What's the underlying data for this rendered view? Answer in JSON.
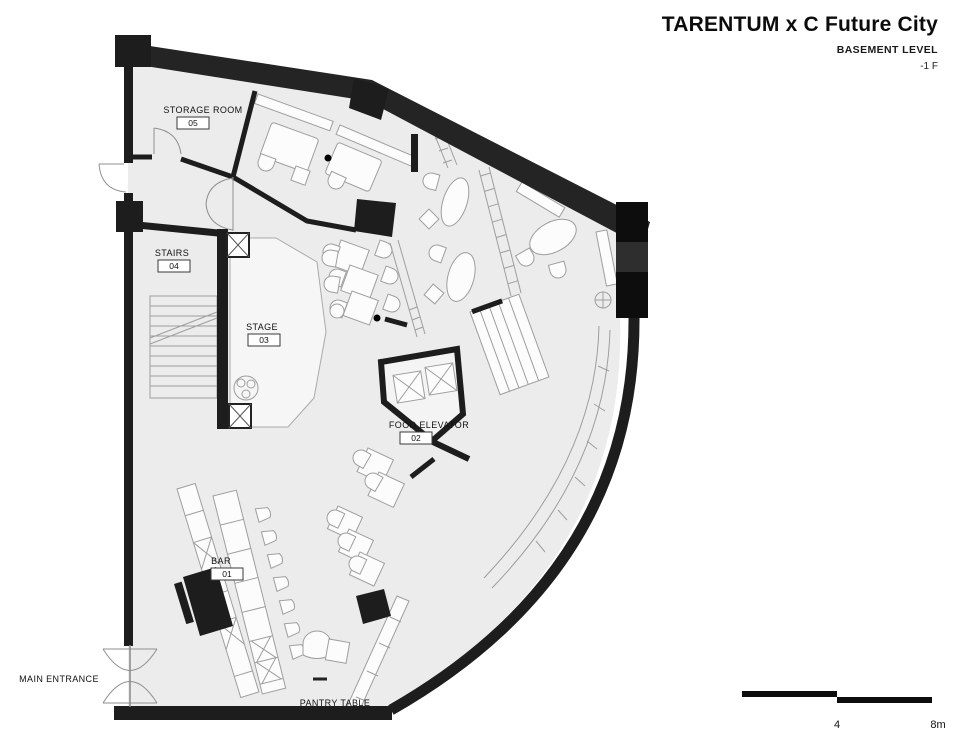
{
  "header": {
    "title": "TARENTUM x C Future City",
    "subtitle": "BASEMENT LEVEL",
    "level": "-1 F"
  },
  "rooms": [
    {
      "name": "BAR",
      "number": "01"
    },
    {
      "name": "FOOD ELEVATOR",
      "number": "02"
    },
    {
      "name": "STAGE",
      "number": "03"
    },
    {
      "name": "STAIRS",
      "number": "04"
    },
    {
      "name": "STORAGE ROOM",
      "number": "05"
    }
  ],
  "annotations": {
    "main_entrance": "MAIN ENTRANCE",
    "pantry_table": "PANTRY TABLE"
  },
  "scale_bar": {
    "mid_label": "4",
    "end_label": "8m"
  },
  "colors": {
    "wall": "#1d1d1d",
    "floor": "#ececec",
    "furniture_stroke": "#9e9e9e"
  }
}
